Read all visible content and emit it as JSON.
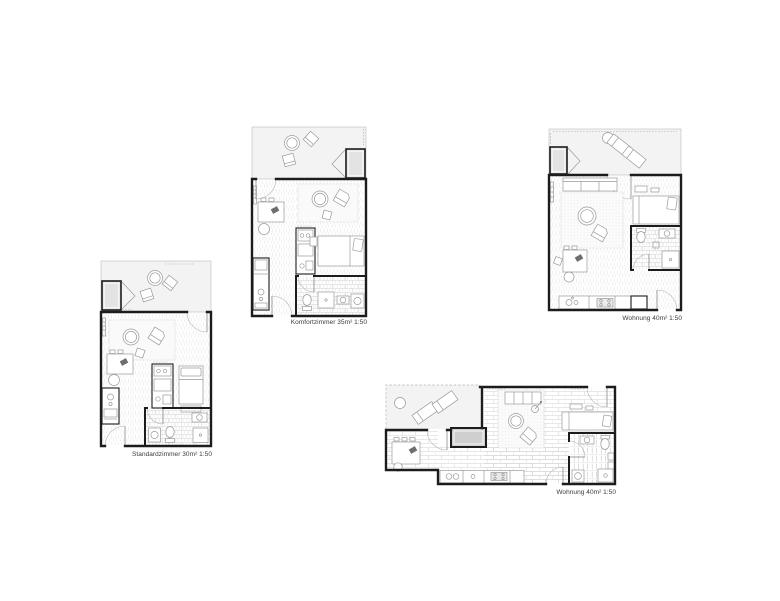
{
  "page": {
    "background": "#ffffff",
    "content": "architectural floor plan sheet with four unit plans"
  },
  "plans": [
    {
      "id": "standardzimmer",
      "label": "Standardzimmer 30m² 1:50"
    },
    {
      "id": "komfortzimmer",
      "label": "Komfortzimmer 35m² 1:50"
    },
    {
      "id": "wohnung-a",
      "label": "Wohnung 40m² 1:50"
    },
    {
      "id": "wohnung-b",
      "label": "Wohnung 40m² 1:50"
    }
  ],
  "colors": {
    "wall": "#1c1c1c",
    "balcony_fill": "#f3f3f3",
    "floor_hatch": "#e1e1e1",
    "tile_line": "#d2d2d2",
    "furniture_line": "#9a9a9a",
    "storage_block_fill": "#e3e3e3",
    "vestibule_fill": "#cfcfcf",
    "label_text": "#3a3a3a"
  }
}
